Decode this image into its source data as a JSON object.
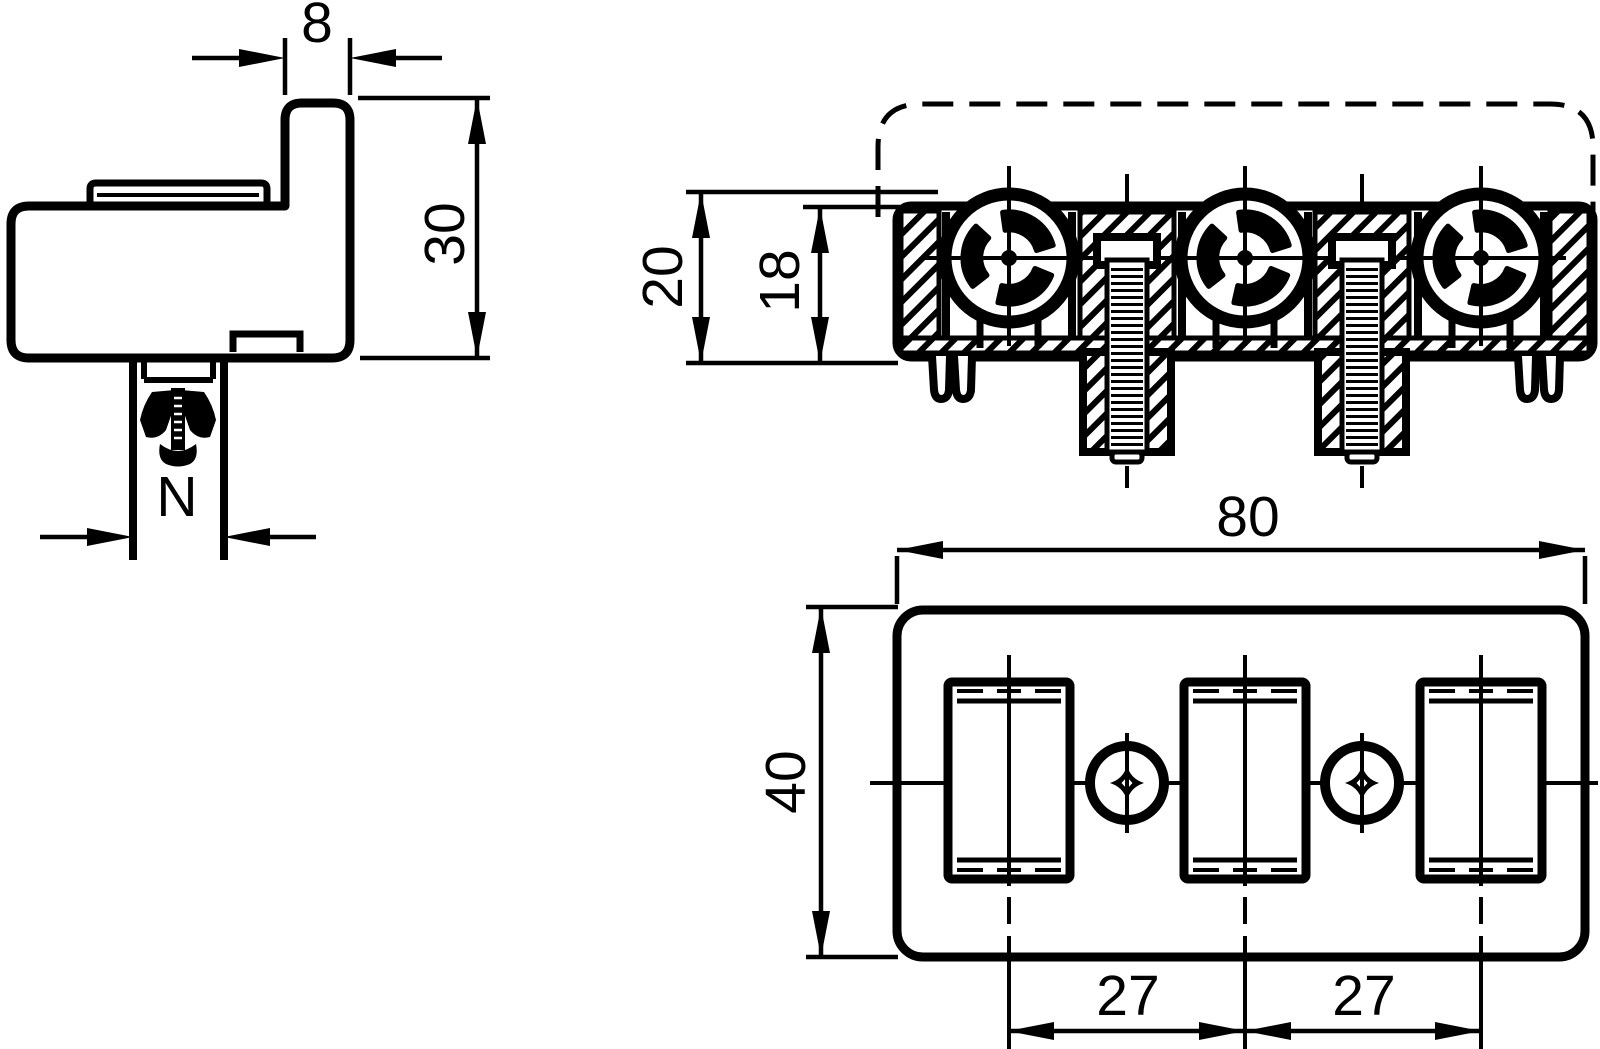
{
  "drawing": {
    "type": "engineering-dimension-drawing",
    "component": "3-pole terminal block with clamping screws and snap-in rivet",
    "views": [
      "side-view",
      "front-section-view",
      "top-view"
    ],
    "colors": {
      "ink": "#000000",
      "background": "#ffffff"
    }
  },
  "labels": {
    "tab_width": "8",
    "body_height": "30",
    "fastener_width": "N",
    "section_outer_height": "20",
    "section_inner_height": "18",
    "overall_width": "80",
    "overall_depth": "40",
    "pitch_left": "27",
    "pitch_right": "27"
  }
}
